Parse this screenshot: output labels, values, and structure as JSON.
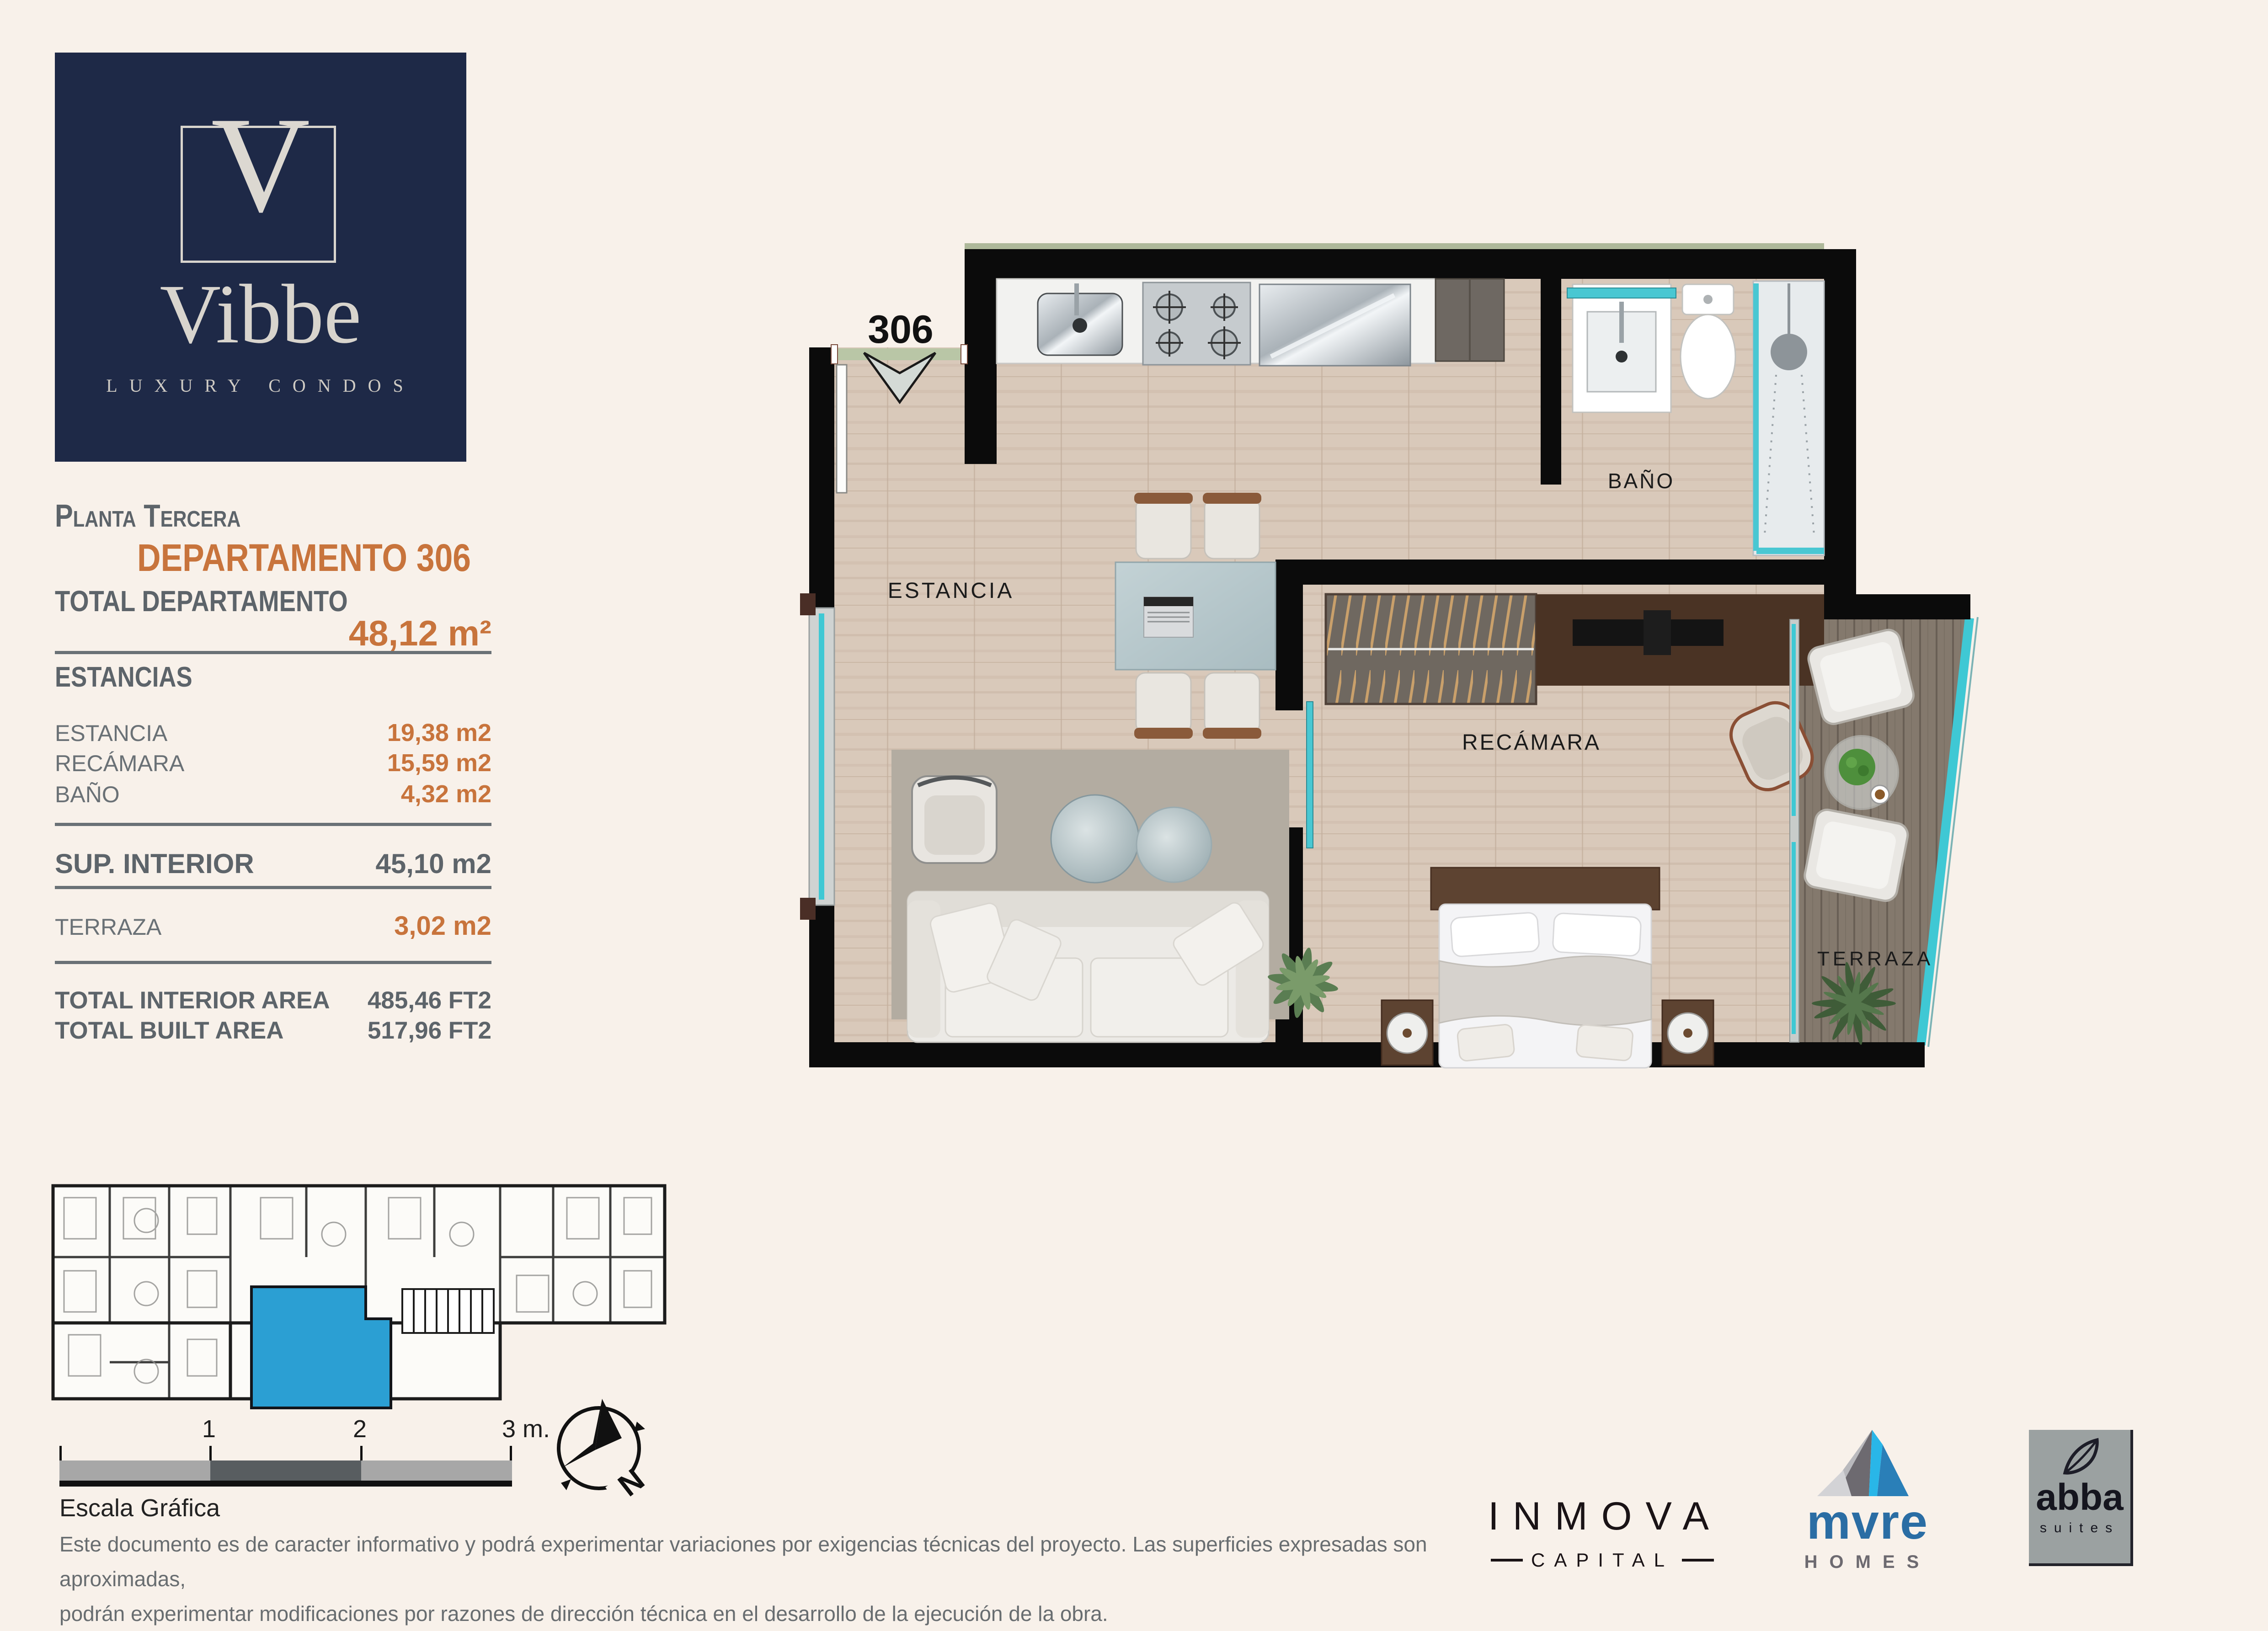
{
  "brand": {
    "monogram": "V",
    "name": "Vibbe",
    "tagline": "LUXURY CONDOS",
    "navy": "#1e2947",
    "cream": "#d8d4cd"
  },
  "sidebar": {
    "floor_label": "Planta Tercera",
    "unit_title": "DEPARTAMENTO 306",
    "total_label": "TOTAL DEPARTAMENTO",
    "total_value": "48,12 m²",
    "sections_heading": "ESTANCIAS",
    "rooms": [
      {
        "label": "ESTANCIA",
        "value": "19,38 m2"
      },
      {
        "label": "RECÁMARA",
        "value": "15,59 m2"
      },
      {
        "label": "BAÑO",
        "value": "4,32 m2"
      }
    ],
    "interior": {
      "label": "SUP. INTERIOR",
      "value": "45,10 m2"
    },
    "terrace": {
      "label": "TERRAZA",
      "value": "3,02 m2"
    },
    "totals": [
      {
        "label": "TOTAL INTERIOR AREA",
        "value": "485,46 FT2"
      },
      {
        "label": "TOTAL BUILT AREA",
        "value": "517,96 FT2"
      }
    ],
    "accent_orange": "#c8743c",
    "text_gray": "#63696e"
  },
  "floorplan": {
    "unit_number": "306",
    "living_label": "ESTANCIA",
    "bedroom_label": "RECÁMARA",
    "bath_label": "BAÑO",
    "terrace_label": "TERRAZA",
    "accent_teal": "#3fc8d4",
    "wall_color": "#0b0b0b",
    "floor_color": "#d9c9ba",
    "highlight_blue": "#2b9fd3"
  },
  "scalebar": {
    "tick1": "1",
    "tick2": "2",
    "tick3": "3 m.",
    "caption": "Escala Gráfica"
  },
  "compass": {
    "north": "N"
  },
  "disclaimer": {
    "line1": "Este documento es de caracter informativo y podrá experimentar variaciones por exigencias técnicas del proyecto. Las superficies expresadas son aproximadas,",
    "line2": "podrán experimentar modificaciones por razones de dirección técnica en el desarrollo de la ejecución de la obra."
  },
  "partners": {
    "inmova_name": "INMOVA",
    "inmova_sub": "CAPITAL",
    "mvre_name": "mvre",
    "mvre_sub": "HOMES",
    "abba_name": "abba",
    "abba_sub": "suites"
  }
}
